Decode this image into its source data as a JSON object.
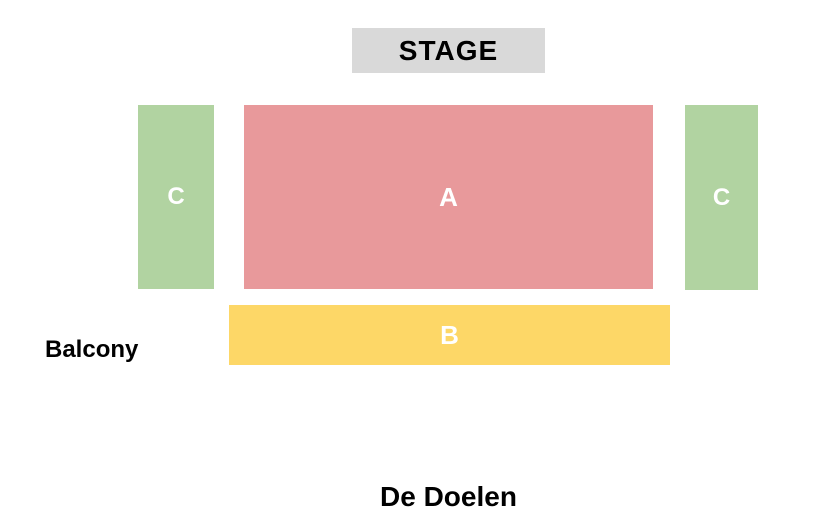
{
  "venue": {
    "name": "De Doelen",
    "stage_label": "STAGE",
    "balcony_label": "Balcony"
  },
  "colors": {
    "stage_bg": "#d9d9d9",
    "section_a": "#e8999b",
    "section_b": "#fdd767",
    "section_c": "#b1d3a1",
    "section_label_text": "#ffffff"
  },
  "sections": [
    {
      "id": "C-left",
      "label": "C",
      "color_key": "section_c"
    },
    {
      "id": "A",
      "label": "A",
      "color_key": "section_a"
    },
    {
      "id": "C-right",
      "label": "C",
      "color_key": "section_c"
    },
    {
      "id": "B",
      "label": "B",
      "color_key": "section_b"
    }
  ]
}
